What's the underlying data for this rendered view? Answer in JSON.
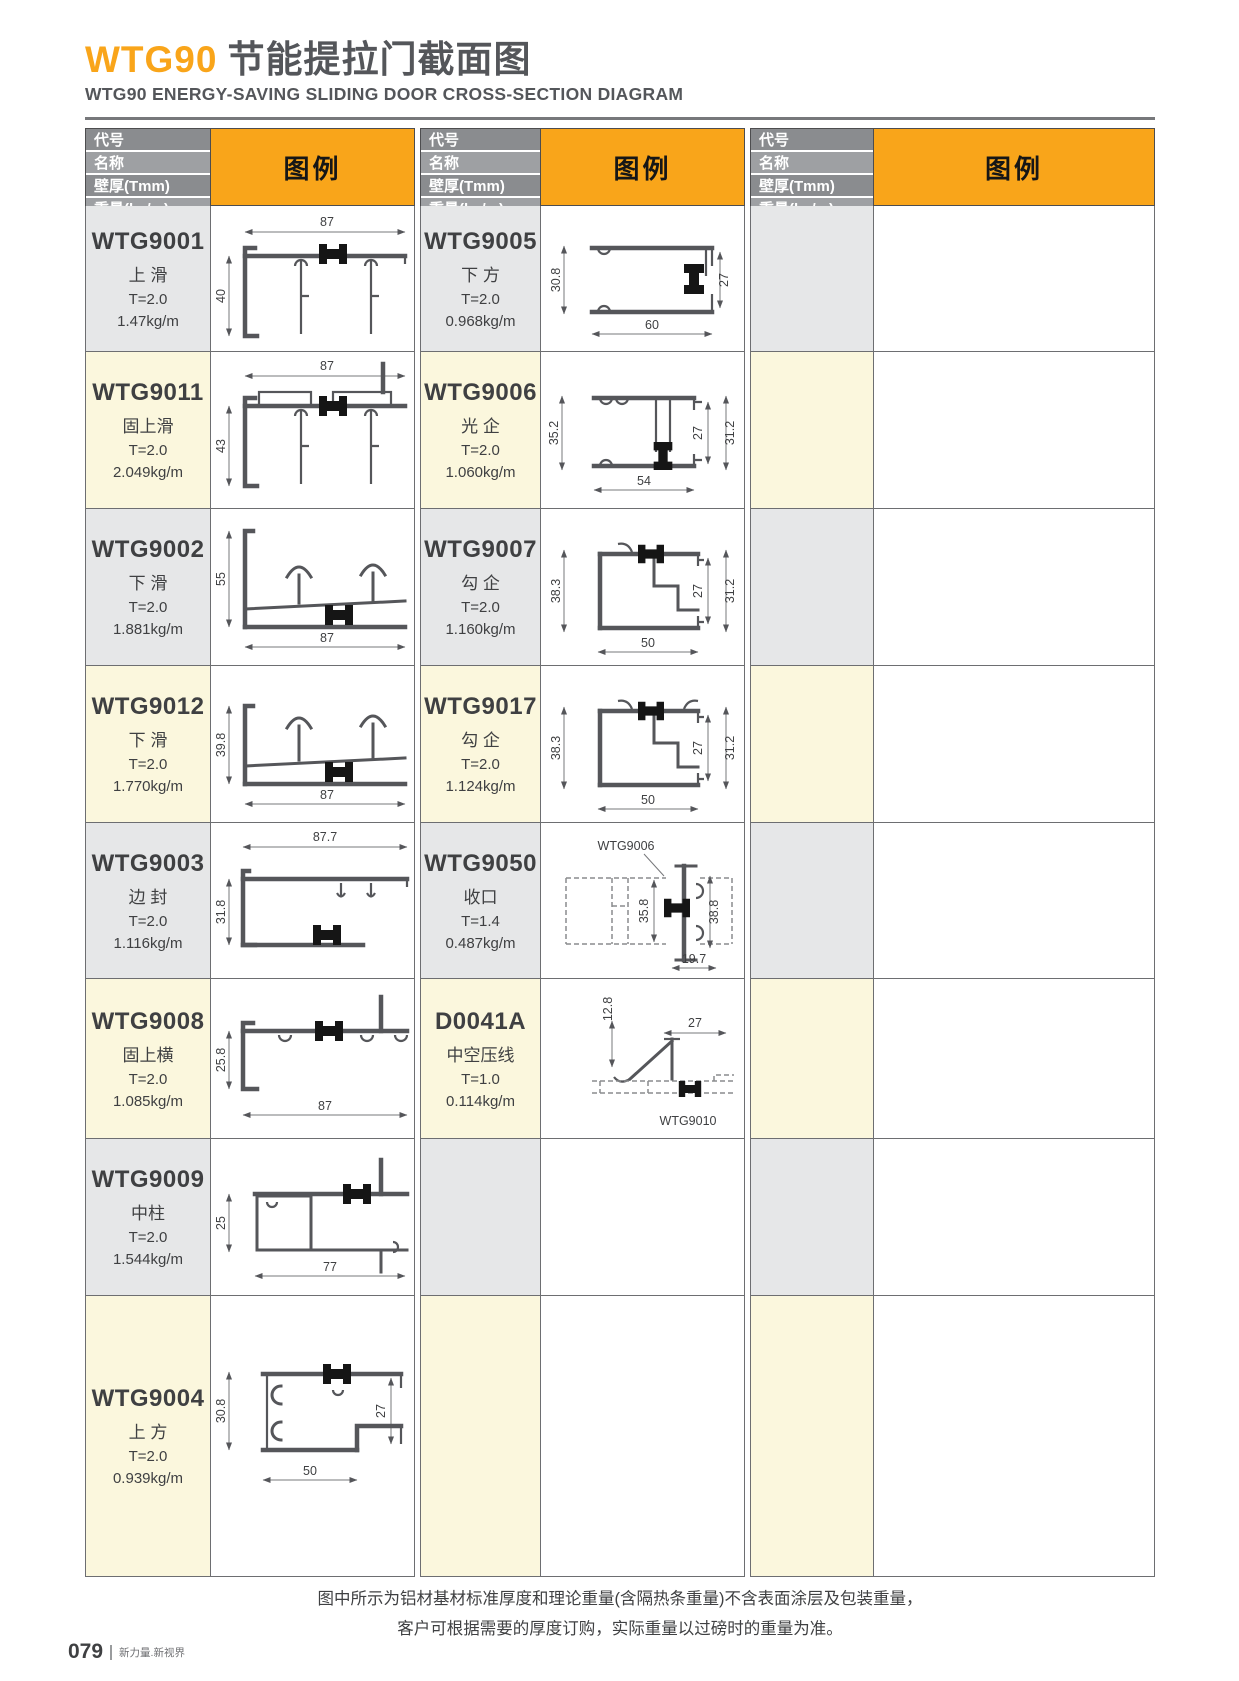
{
  "page": {
    "title_code": "WTG90",
    "title_cn": "节能提拉门截面图",
    "subtitle": "WTG90 ENERGY-SAVING SLIDING DOOR CROSS-SECTION DIAGRAM",
    "note1": "图中所示为铝材基材标准厚度和理论重量(含隔热条重量)不含表面涂层及包装重量，",
    "note2": "客户可根据需要的厚度订购，实际重量以过磅时的重量为准。",
    "page_number": "079",
    "brand": "新力量.新视界"
  },
  "header": {
    "labels": [
      "代号",
      "名称",
      "壁厚(Tmm)",
      "重量(kg/m)"
    ],
    "legend": "图例"
  },
  "colors": {
    "accent_orange": "#F9A51A",
    "header_gray_dark": "#8A8C8F",
    "header_gray_light": "#9EA0A3",
    "row_gray": "#E6E7E8",
    "row_cream": "#FBF7DD",
    "profile_gray": "#55565A"
  },
  "columns": [
    {
      "products": [
        {
          "code": "WTG9001",
          "name": "上 滑",
          "t": "T=2.0",
          "w": "1.47kg/m",
          "dims": {
            "w": "87",
            "h": "40"
          }
        },
        {
          "code": "WTG9011",
          "name": "固上滑",
          "t": "T=2.0",
          "w": "2.049kg/m",
          "dims": {
            "w": "87",
            "h": "43"
          }
        },
        {
          "code": "WTG9002",
          "name": "下 滑",
          "t": "T=2.0",
          "w": "1.881kg/m",
          "dims": {
            "w": "87",
            "h": "55"
          }
        },
        {
          "code": "WTG9012",
          "name": "下 滑",
          "t": "T=2.0",
          "w": "1.770kg/m",
          "dims": {
            "w": "87",
            "h": "39.8"
          }
        },
        {
          "code": "WTG9003",
          "name": "边 封",
          "t": "T=2.0",
          "w": "1.116kg/m",
          "dims": {
            "w": "87.7",
            "h": "31.8"
          }
        },
        {
          "code": "WTG9008",
          "name": "固上横",
          "t": "T=2.0",
          "w": "1.085kg/m",
          "dims": {
            "w": "87",
            "h": "25.8"
          }
        },
        {
          "code": "WTG9009",
          "name": "中柱",
          "t": "T=2.0",
          "w": "1.544kg/m",
          "dims": {
            "w": "77",
            "h": "25"
          }
        },
        {
          "code": "WTG9004",
          "name": "上 方",
          "t": "T=2.0",
          "w": "0.939kg/m",
          "dims": {
            "w": "50",
            "h": "30.8",
            "r": "27"
          }
        }
      ]
    },
    {
      "products": [
        {
          "code": "WTG9005",
          "name": "下 方",
          "t": "T=2.0",
          "w": "0.968kg/m",
          "dims": {
            "w": "60",
            "h": "30.8",
            "r": "27"
          }
        },
        {
          "code": "WTG9006",
          "name": "光 企",
          "t": "T=2.0",
          "w": "1.060kg/m",
          "dims": {
            "w": "54",
            "h": "35.2",
            "r": "27",
            "r2": "31.2"
          }
        },
        {
          "code": "WTG9007",
          "name": "勾 企",
          "t": "T=2.0",
          "w": "1.160kg/m",
          "dims": {
            "w": "50",
            "h": "38.3",
            "r": "27",
            "r2": "31.2"
          }
        },
        {
          "code": "WTG9017",
          "name": "勾 企",
          "t": "T=2.0",
          "w": "1.124kg/m",
          "dims": {
            "w": "50",
            "h": "38.3",
            "r": "27",
            "r2": "31.2"
          }
        },
        {
          "code": "WTG9050",
          "name": "收口",
          "t": "T=1.4",
          "w": "0.487kg/m",
          "dims": {
            "w": "19.7",
            "h": "35.8",
            "r": "38.8",
            "ref": "WTG9006"
          }
        },
        {
          "code": "D0041A",
          "name": "中空压线",
          "t": "T=1.0",
          "w": "0.114kg/m",
          "dims": {
            "h": "12.8",
            "r": "27",
            "ref": "WTG9010"
          }
        }
      ]
    },
    {
      "products": []
    }
  ]
}
